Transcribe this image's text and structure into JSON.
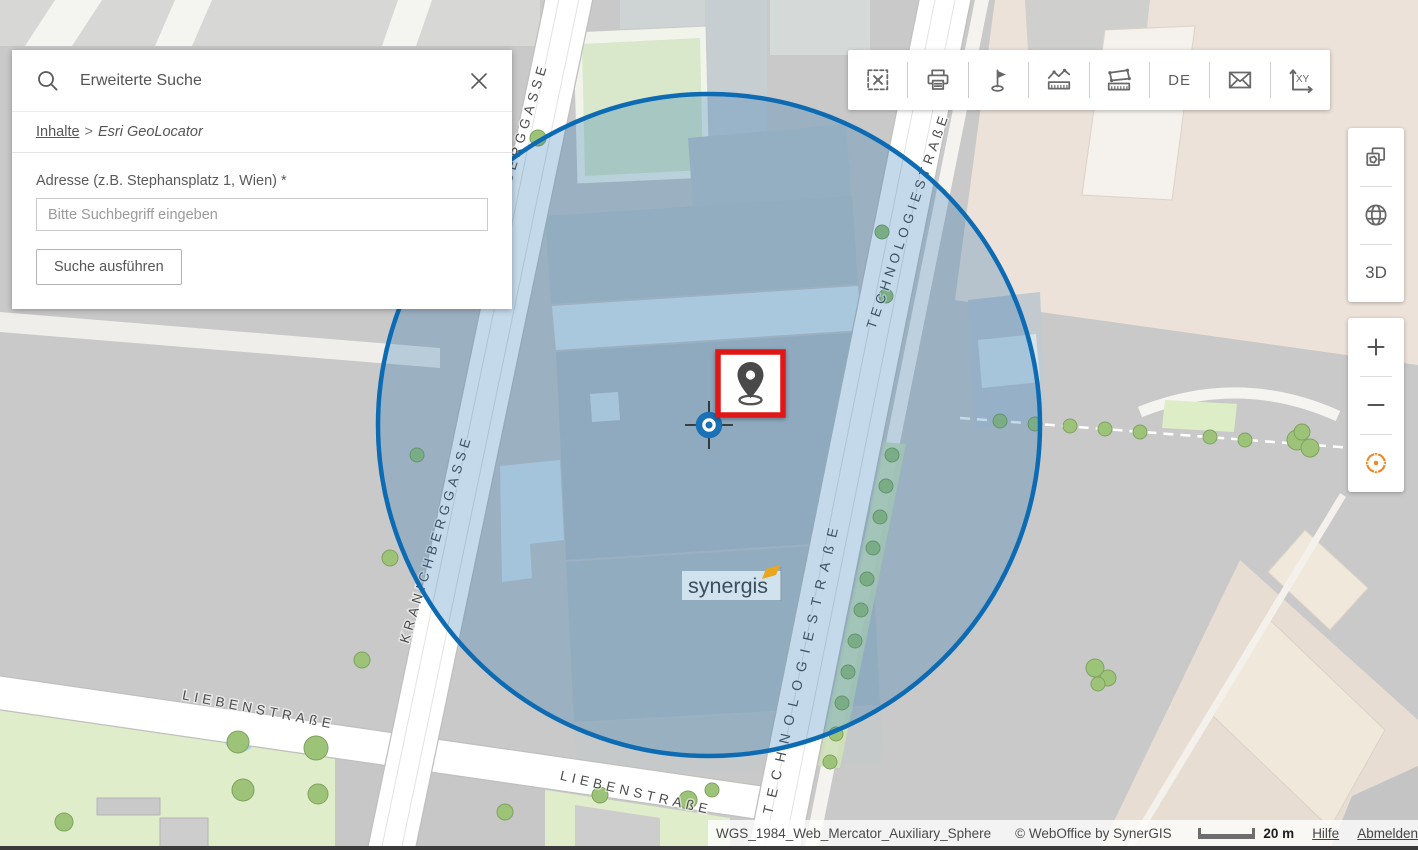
{
  "search_panel": {
    "title": "Erweiterte Suche",
    "breadcrumb": {
      "root": "Inhalte",
      "separator": ">",
      "current": "Esri GeoLocator"
    },
    "address_label": "Adresse (z.B. Stephansplatz 1, Wien) *",
    "address_placeholder": "Bitte Suchbegriff eingeben",
    "search_button": "Suche ausführen"
  },
  "top_toolbar": {
    "items": [
      "select",
      "print",
      "redlining-flag",
      "measure-distance",
      "measure-area",
      "language",
      "mail",
      "coordinates"
    ],
    "language_label": "DE",
    "xy_label": "XY"
  },
  "right_toolbar": {
    "three_d_label": "3D"
  },
  "map": {
    "streets": {
      "kranichberggasse": "KRANICHBERGGASSE",
      "technologiestrasse": "TECHNOLOGIESTRAßE",
      "liebenstrasse": "LIEBENSTRAßE"
    },
    "building_logo": "synergis"
  },
  "status_bar": {
    "projection": "WGS_1984_Web_Mercator_Auxiliary_Sphere",
    "copyright": "© WebOffice by SynerGIS",
    "scale_text": "20 m",
    "help_link": "Hilfe",
    "logout_link": "Abmelden"
  },
  "colors": {
    "buffer_fill": "rgba(20,105,170,0.25)",
    "buffer_stroke": "#0d6bb3",
    "marker_border": "#e11414",
    "geolocate_orange": "#ed8a21"
  }
}
